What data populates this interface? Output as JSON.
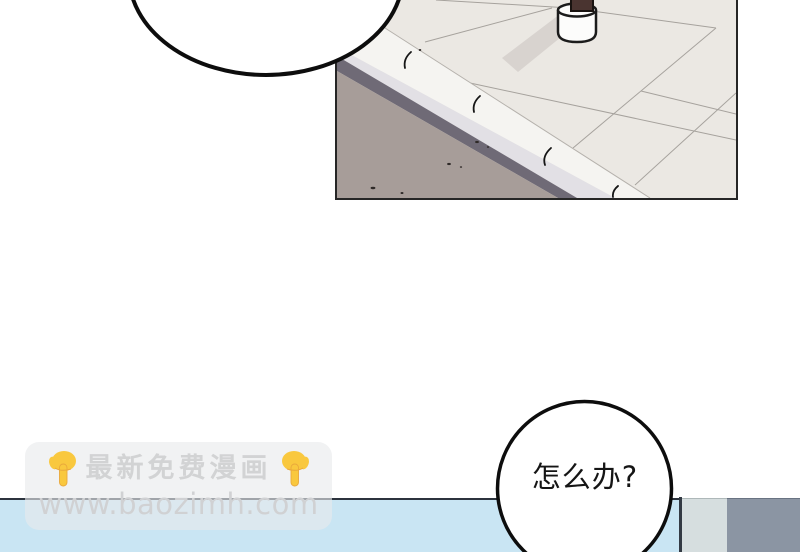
{
  "page": {
    "background": "#ffffff",
    "type_note": "comic page"
  },
  "panels": {
    "street_panel": {
      "colors": {
        "sidewalk": "#ebe8e3",
        "road": "#a79d99",
        "curb_shadow": "#6f6a76",
        "curb_front": "#e2e0e5",
        "curb_top": "#f5f4f1",
        "tile_line": "#a6a29d",
        "pole": "#4a3430",
        "pole_base": "#fcfcfb",
        "pole_shadow": "#d8d3cf",
        "border": "#262626"
      }
    },
    "bottom_panel": {
      "colors": {
        "sky_blue": "#c9e5f3",
        "top_line": "#2c333d",
        "vertical_line": "#333a44",
        "light_block": "#d6dedf",
        "gray_block": "#8b95a3"
      }
    }
  },
  "speech_bubbles": {
    "top_left": {
      "text": ""
    },
    "bottom_right": {
      "text": "怎么办?"
    }
  },
  "watermark": {
    "promo_text": "最新免费漫画",
    "url": "www.baozimh.com",
    "left_icon": "backhand-index-pointing-down-icon",
    "right_icon": "backhand-index-pointing-down-icon",
    "icon_color": "#f9c83e",
    "text_color": "#d2d3d4"
  }
}
